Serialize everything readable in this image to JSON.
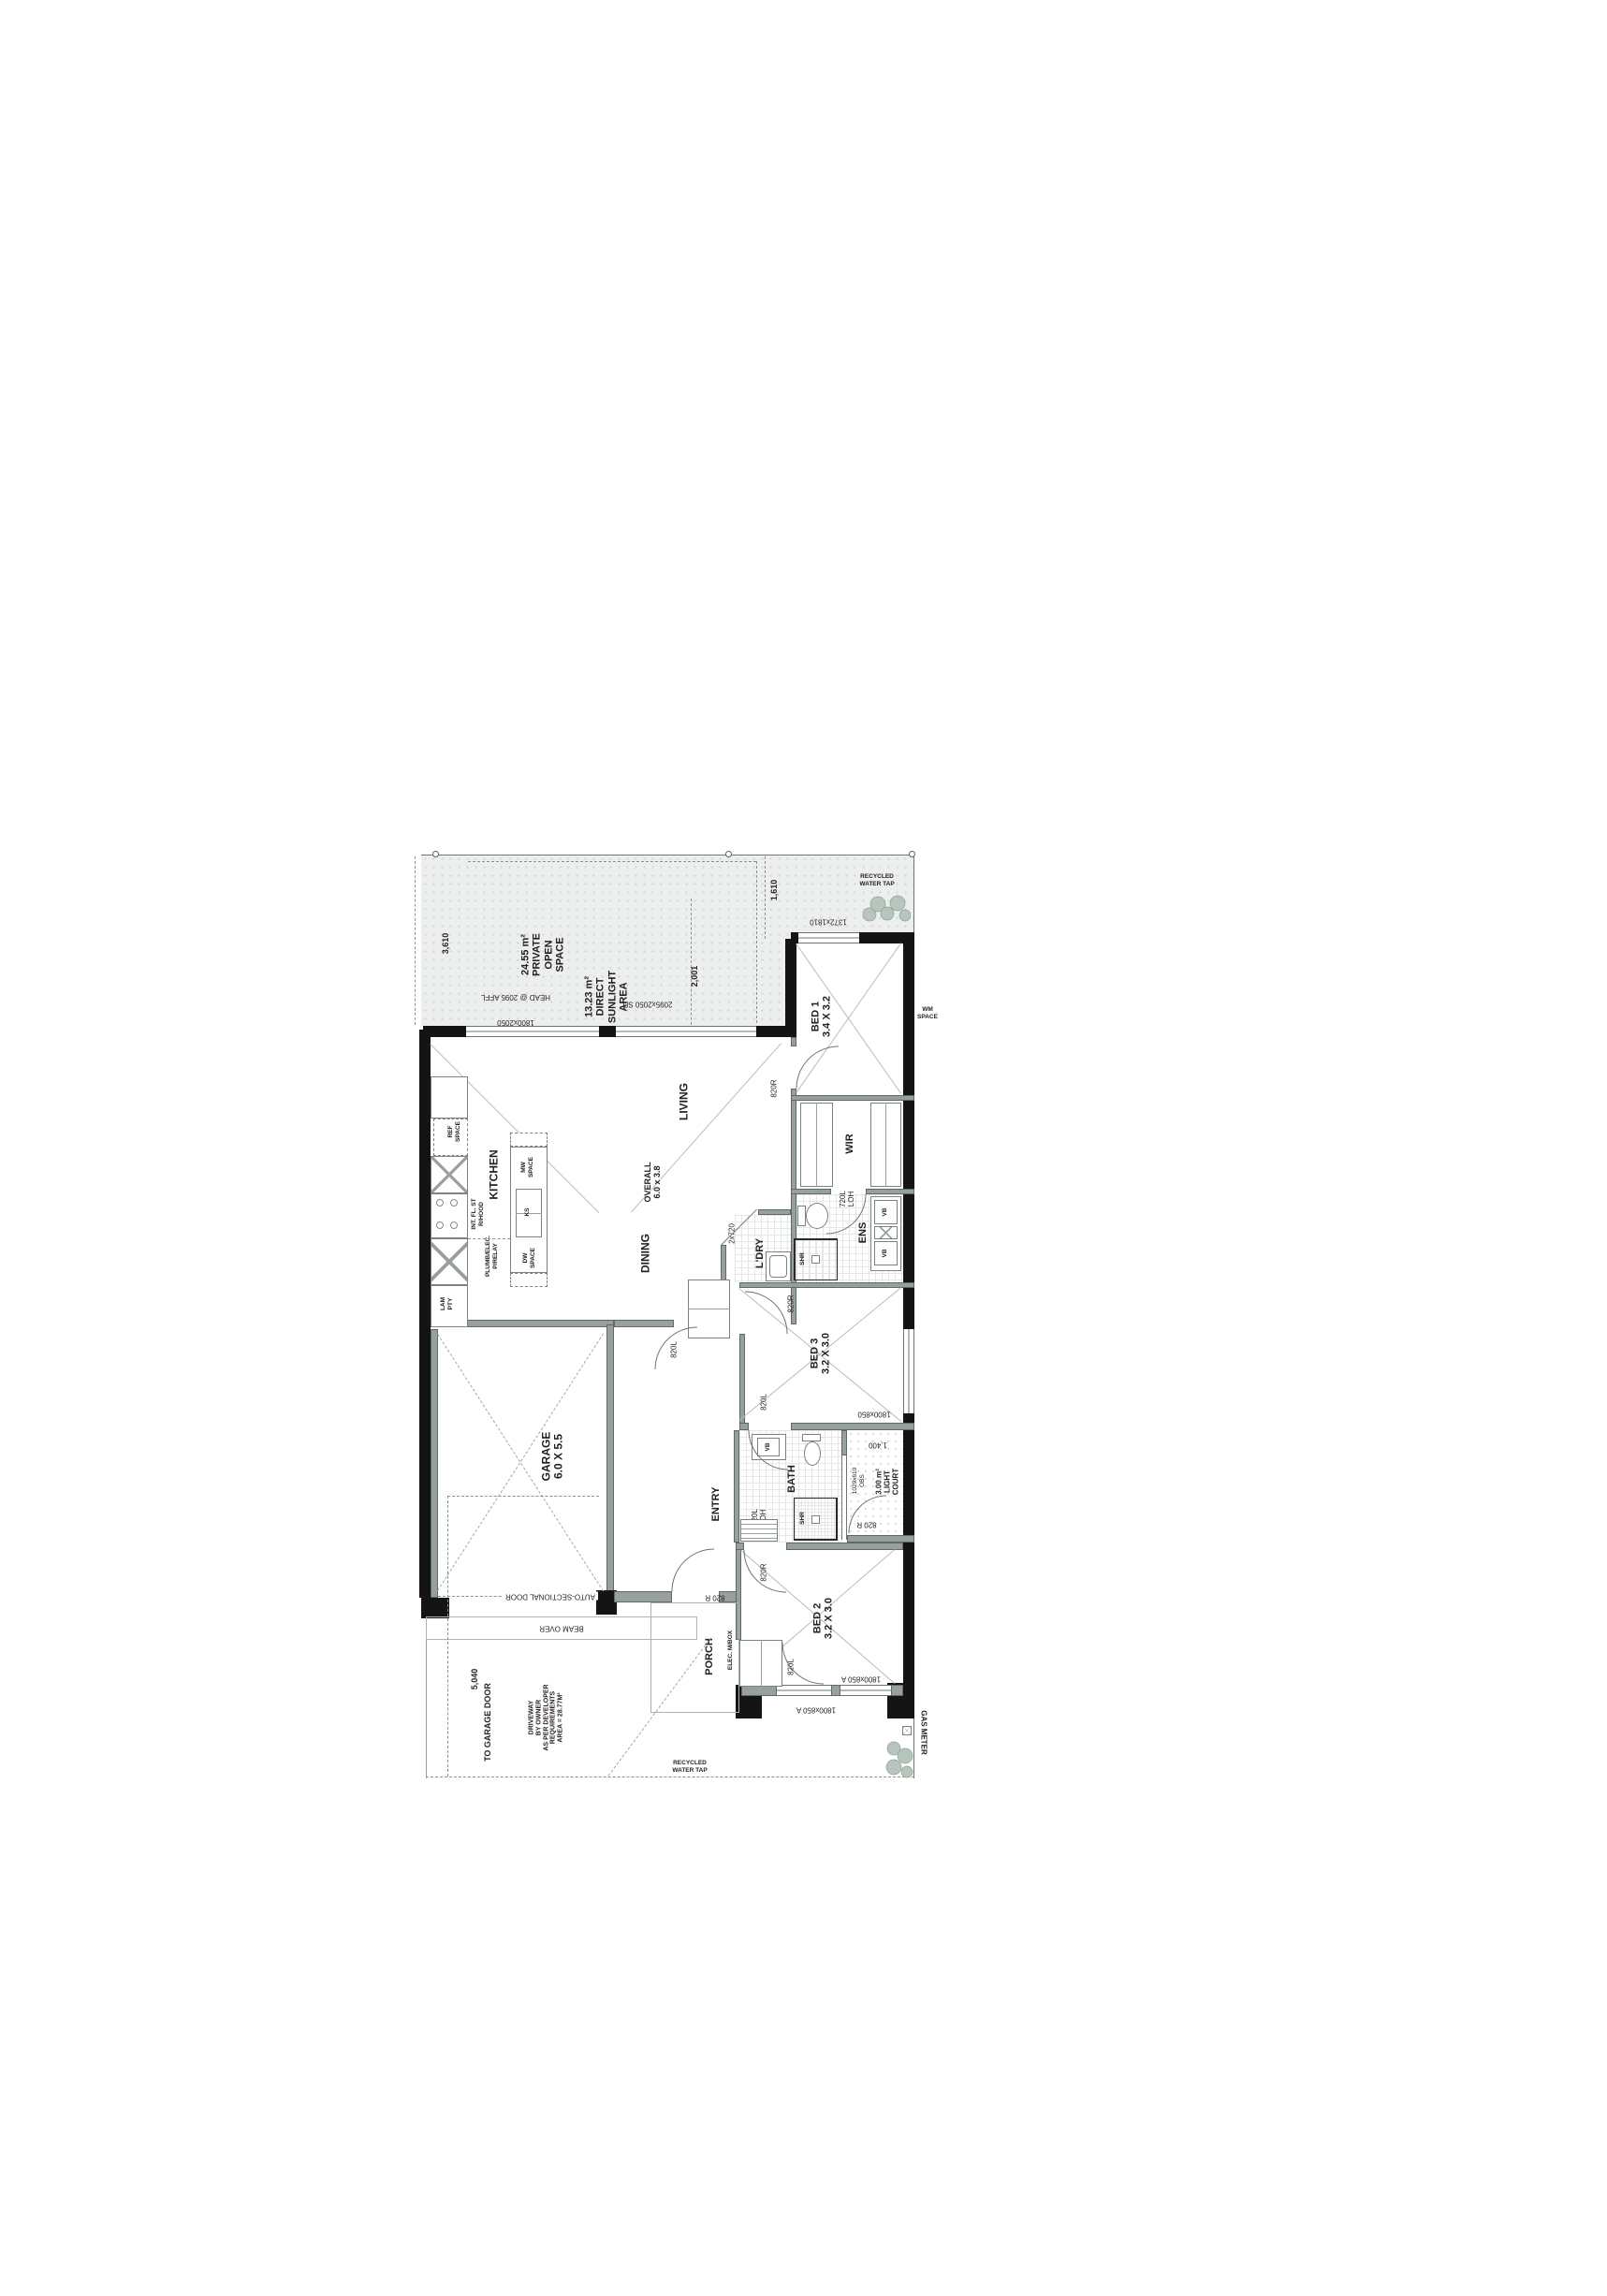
{
  "rooms": {
    "living": "LIVING",
    "dining": "DINING",
    "kitchen": "KITCHEN",
    "overall": "OVERALL\n6.0 x 3.8",
    "entry": "ENTRY",
    "porch": "PORCH",
    "garage": "GARAGE\n6.0 X 5.5",
    "bed1": "BED 1\n3.4 X 3.2",
    "bed2": "BED 2\n3.2 X 3.0",
    "bed3": "BED 3\n3.2 X 3.0",
    "wir": "WIR",
    "ens": "ENS",
    "bath": "BATH",
    "ldry": "L'DRY",
    "robe": "ROBE",
    "light_court": "3.00 m²\nLIGHT\nCOURT"
  },
  "site": {
    "private_open_space": "24.55 m²\nPRIVATE\nOPEN\nSPACE",
    "direct_sunlight": "13.23 m²\nDIRECT\nSUNLIGHT\nAREA",
    "driveway_note": "DRIVEWAY\nBY OWNER\nAS PER DEVELOPER\nREQUIREMENTS\nAREA = 28.77M²",
    "to_garage_door": "TO GARAGE DOOR",
    "beam_over": "BEAM OVER",
    "auto_sectional_door": "AUTO-SECTIONAL DOOR",
    "gas_meter": "GAS METER",
    "recycled_water_tap": "RECYCLED\nWATER TAP",
    "wm_space": "WM\nSPACE",
    "elec_mbox": "ELEC. M/BOX"
  },
  "kitchen_items": {
    "ref": "REF\nSPACE",
    "mw": "MW\nSPACE",
    "dw": "DW\nSPACE",
    "ks": "KS",
    "lam_pty": "LAM\nPTY",
    "rhood": "INT. FL. ST\nR/HOOD",
    "plumb": "PLUMB/ELEC.\nP/RELAY"
  },
  "doors": {
    "d820l": "820L",
    "d820r": "820R",
    "d820r_sp": "820 R",
    "d720_loh": "720L\nLOH",
    "d2x720": "2x720"
  },
  "windows": {
    "w_living": "1800x2050",
    "w_living_head": "HEAD @ 2095 AFFL",
    "w_slider": "2095x2050 SD",
    "w_bed1": "1372x1810",
    "w_bed3": "1800x850",
    "w_bed2": "1800x850 A",
    "w_obs": "1029x610\nOBS"
  },
  "dimensions": {
    "d3610": "3,610",
    "d1610": "1,610",
    "d2001": "2,001",
    "d1400": "1,400",
    "d5040": "5,040"
  },
  "fixtures": {
    "vb": "VB",
    "shr": "SHR"
  }
}
